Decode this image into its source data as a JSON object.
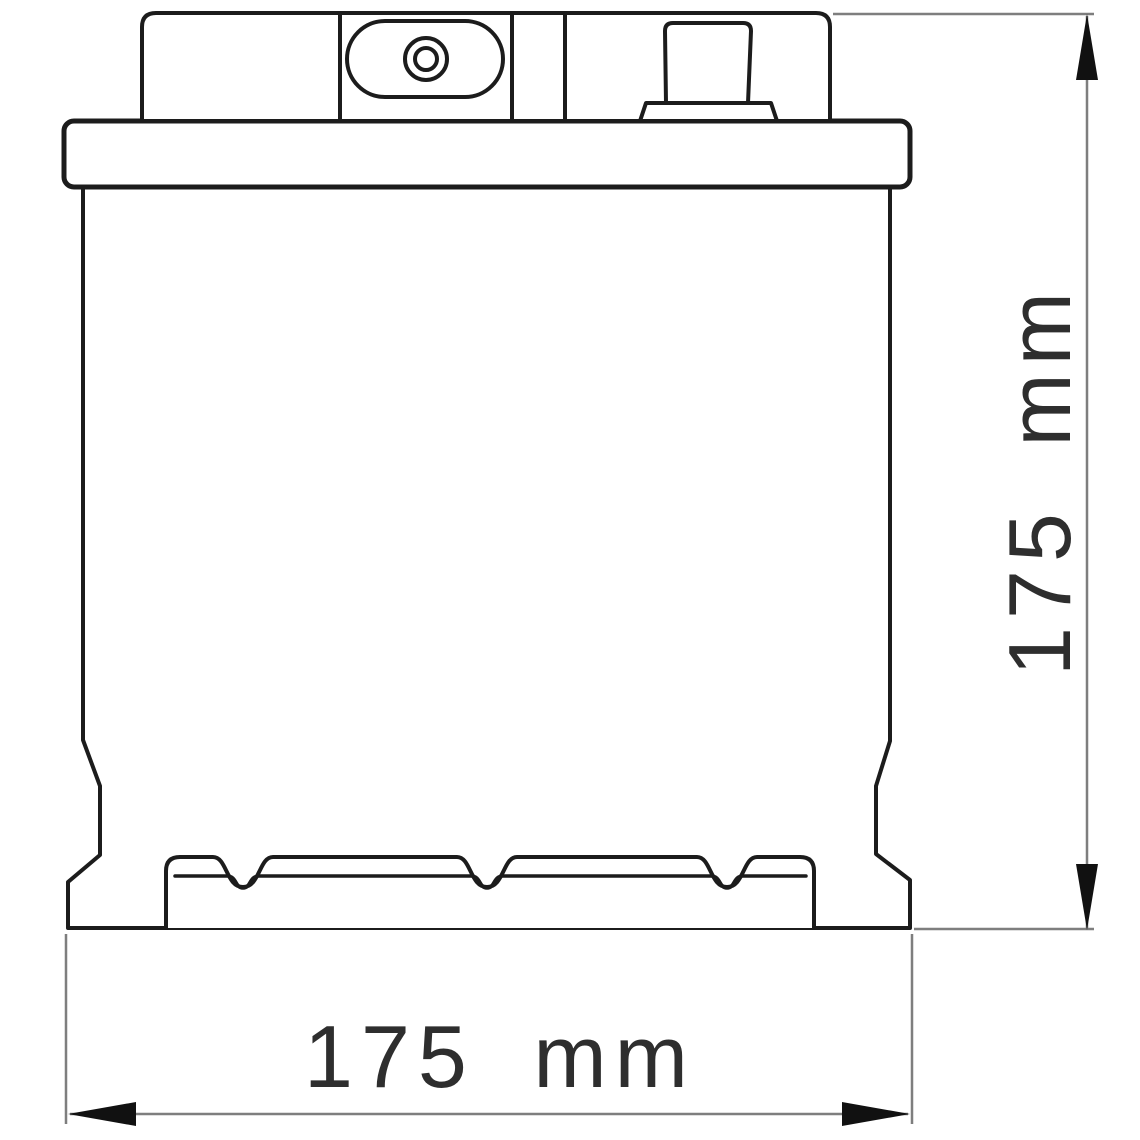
{
  "diagram": {
    "height_dimension": {
      "label": "175 mm"
    },
    "width_dimension": {
      "label": "175 mm"
    }
  },
  "colors": {
    "background": "#ffffff",
    "outline": "#1c1c1c",
    "dimension_line": "#7e7e7e",
    "arrow": "#111111",
    "label_text": "#2e2e2e"
  }
}
